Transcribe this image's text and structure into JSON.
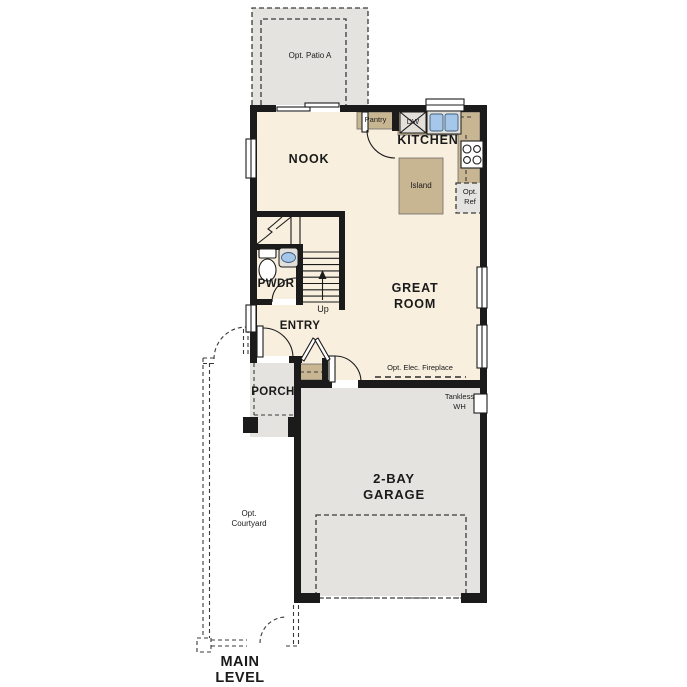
{
  "labels": {
    "opt_patio": "Opt. Patio A",
    "nook": "NOOK",
    "pantry": "Pantry",
    "dw": "DW",
    "kitchen": "KITCHEN",
    "island": "Island",
    "opt_ref": "Opt. Ref",
    "great_room": "GREAT ROOM",
    "pwdr": "PWDR",
    "up": "Up",
    "entry": "ENTRY",
    "porch": "PORCH",
    "fireplace": "Opt. Elec. Fireplace",
    "tankless_wh": "Tankless WH",
    "garage": "2-BAY GARAGE",
    "opt_courtyard": "Opt. Courtyard",
    "main_level": "MAIN LEVEL"
  },
  "colors": {
    "wall": "#1b1b1b",
    "floor": "#f8efdf",
    "concrete": "#e4e3e0",
    "counter": "#c8b592",
    "blue": "#a5c7e9"
  }
}
